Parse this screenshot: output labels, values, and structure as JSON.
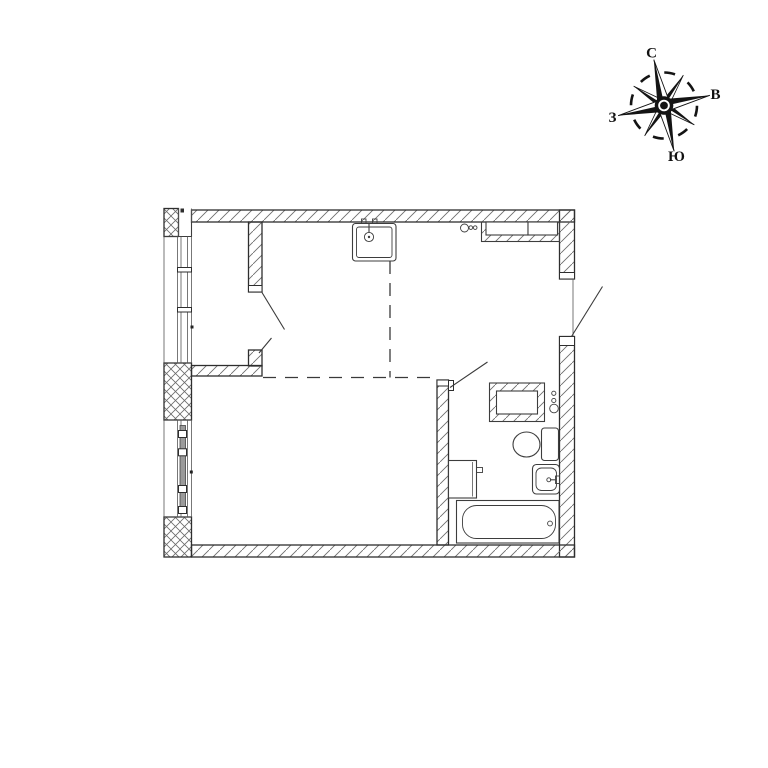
{
  "compass": {
    "north_label": "С",
    "east_label": "В",
    "south_label": "Ю",
    "west_label": "З"
  },
  "colors": {
    "background": "#ffffff",
    "wall_line": "#2e2e2e",
    "fixture_line": "#3d3d3d",
    "hatch_line": "#6b6b6b"
  },
  "floor_plan": {
    "type": "apartment-floor-plan",
    "fixtures": [
      "kitchen-sink",
      "kitchen-risers",
      "kitchen-vent-shaft",
      "bathroom-vent-shaft",
      "bathroom-risers",
      "washing-machine",
      "toilet",
      "washbasin",
      "bathtub"
    ],
    "openings": [
      "room-double-door",
      "bathroom-door",
      "entrance-door"
    ],
    "windows": [
      "upper-window",
      "lower-window-with-balcony-sash"
    ],
    "zones": [
      "kitchen-zone-dashed-boundary"
    ]
  }
}
